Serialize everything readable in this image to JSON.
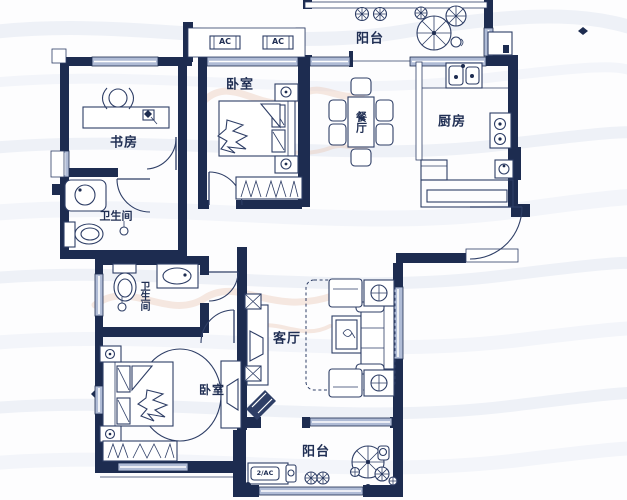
{
  "page": {
    "kind": "residential floor plan drawing",
    "width": 627,
    "height": 500
  },
  "colors": {
    "wall": "#1d2c50",
    "furniture_line": "#2e3e66",
    "window_fill": "#b0bcd6",
    "background": "#fdfdfe",
    "wave_watermark": "#eef1f7",
    "logo_watermark": "#eac7b8",
    "text": "#1f2e53"
  },
  "rooms": {
    "balcony_top": {
      "label": "阳台"
    },
    "bedroom_top": {
      "label": "卧室"
    },
    "dining": {
      "label": "餐厅"
    },
    "kitchen": {
      "label": "厨房"
    },
    "study": {
      "label": "书房"
    },
    "bath_upper": {
      "label": "卫生间"
    },
    "bath_lower": {
      "label": "卫生间"
    },
    "living": {
      "label": "客厅"
    },
    "bedroom_bottom": {
      "label": "卧室"
    },
    "balcony_bottom": {
      "label": "阳台"
    }
  },
  "annotations": {
    "ac_unit_left": "AC",
    "ac_unit_right": "AC",
    "ac_unit_bottom": "2/AC"
  }
}
